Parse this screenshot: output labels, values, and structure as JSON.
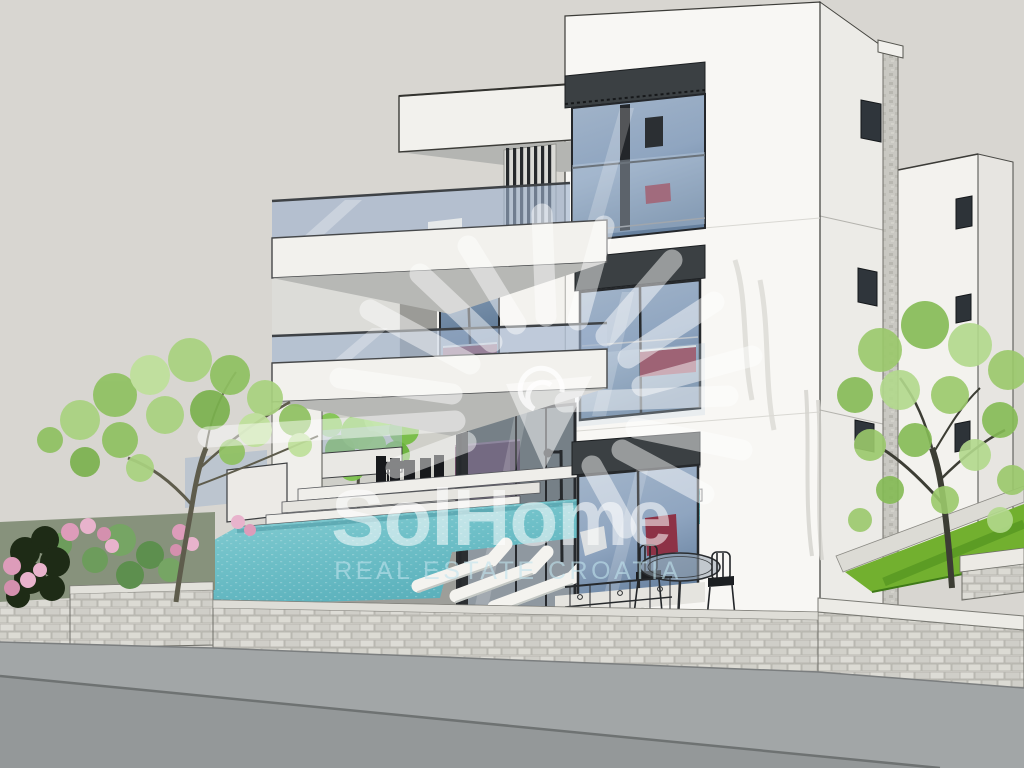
{
  "watermark": {
    "logo": "sun-rays-logo",
    "title": "SolHome",
    "subtitle": "REAL ESTATE CROATIA"
  },
  "colors": {
    "sky": "#d8d6d1",
    "wall-sunlit": "#f8f7f4",
    "wall-shaded": "#ecebe7",
    "slab": "#f2f1ed",
    "frame-dark": "#3b4043",
    "glass-blue": "#8fa5c0",
    "balcony-glass": "#9eb2cd",
    "pool-water": "#6fc0c8",
    "pool-deep": "#55acb8",
    "stone-wall": "#d6d5cf",
    "road": "#a2a6a7",
    "lawn": "#72b02f",
    "foliage": "#8fc161",
    "flowers": "#dd9cba",
    "furniture-red": "#8d3246",
    "interior-purple": "#6e4e66",
    "watermark-white": "#ffffff",
    "watermark-subtitle": "#bfe3ec"
  }
}
